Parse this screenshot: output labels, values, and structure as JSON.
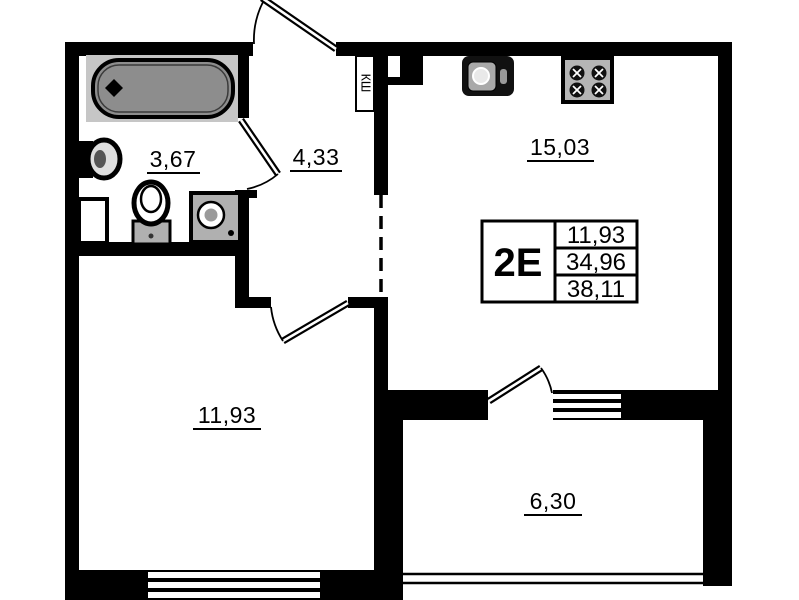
{
  "rooms": {
    "bathroom": {
      "area": "3,67"
    },
    "hallway": {
      "area": "4,33"
    },
    "kitchen": {
      "area": "15,03"
    },
    "living_room": {
      "area": "11,93"
    },
    "balcony": {
      "area": "6,30"
    }
  },
  "duct_label": "КШ",
  "info_table": {
    "unit_type": "2Е",
    "rows": [
      "11,93",
      "34,96",
      "38,11"
    ]
  },
  "colors": {
    "wall": "#000000",
    "background": "#ffffff",
    "tub_fill": "#8d8d8d",
    "fixture_gray": "#b0b0b0",
    "surround_gray": "#c6c6c6"
  }
}
